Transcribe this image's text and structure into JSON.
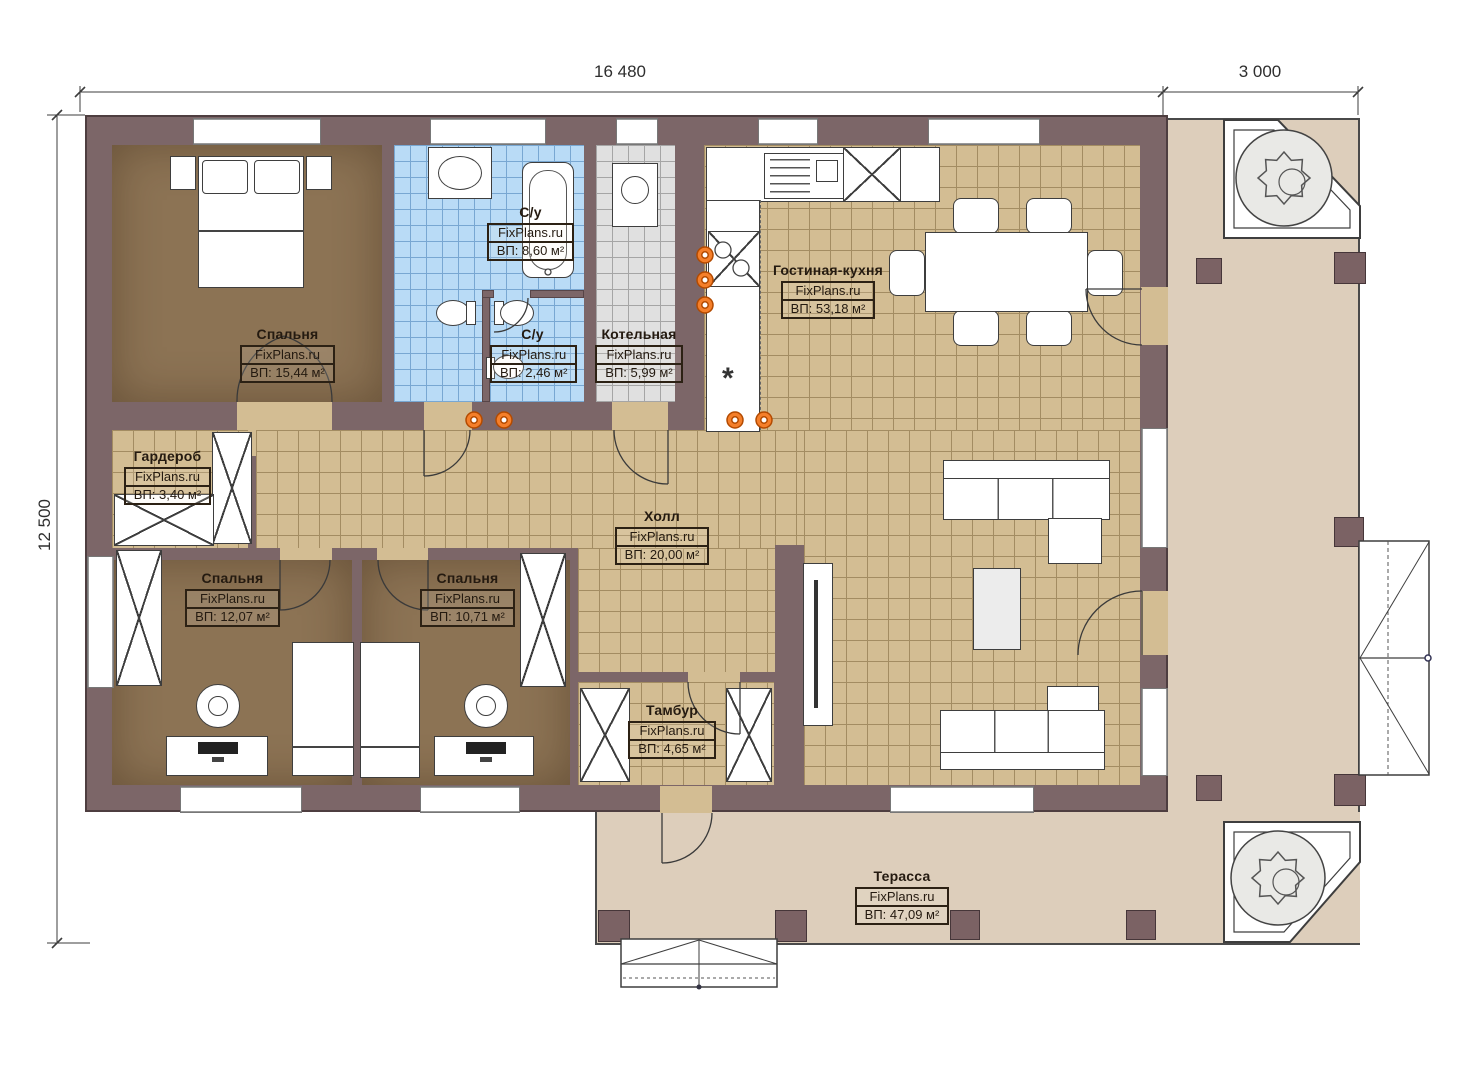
{
  "dimensions": {
    "top_main": "16 480",
    "top_right": "3 000",
    "left": "12 500"
  },
  "watermark": "FixPlans.ru",
  "rooms": [
    {
      "id": "bedroom-master",
      "name": "Спальня",
      "area": "ВП: 15,44 м²"
    },
    {
      "id": "bathroom-main",
      "name": "С/у",
      "area": "ВП: 8,60 м²"
    },
    {
      "id": "bathroom-small",
      "name": "С/у",
      "area": "ВП: 2,46 м²"
    },
    {
      "id": "boiler-room",
      "name": "Котельная",
      "area": "ВП: 5,99 м²"
    },
    {
      "id": "living-kitchen",
      "name": "Гостиная-кухня",
      "area": "ВП: 53,18 м²"
    },
    {
      "id": "wardrobe-room",
      "name": "Гардероб",
      "area": "ВП: 3,40 м²"
    },
    {
      "id": "hall",
      "name": "Холл",
      "area": "ВП: 20,00 м²"
    },
    {
      "id": "bedroom-2",
      "name": "Спальня",
      "area": "ВП: 12,07 м²"
    },
    {
      "id": "bedroom-3",
      "name": "Спальня",
      "area": "ВП: 10,71 м²"
    },
    {
      "id": "vestibule",
      "name": "Тамбур",
      "area": "ВП: 4,65 м²"
    },
    {
      "id": "terrace",
      "name": "Терасса",
      "area": "ВП: 47,09 м²"
    }
  ],
  "symbols": {
    "gas_mark": "*"
  },
  "colors": {
    "wall": "#7c6668",
    "floor_wood": "#8c7354",
    "tile_tan": "#d3bd93",
    "tile_blue": "#b9dbf6",
    "tile_gray": "#e0e0e0",
    "terrace": "#ddcebb",
    "radiator": "#f57f2a"
  }
}
